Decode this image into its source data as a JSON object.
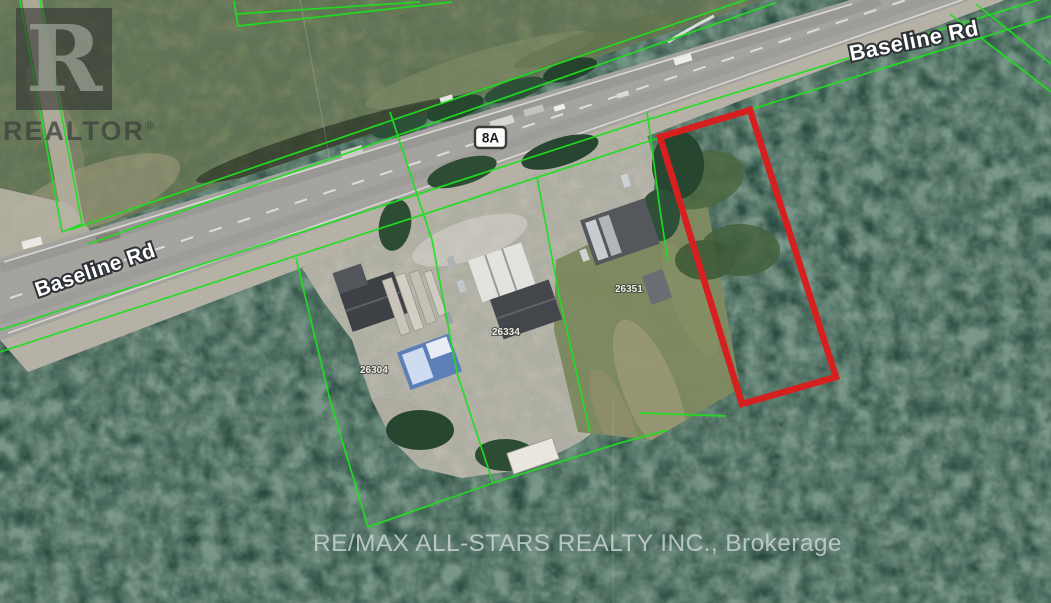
{
  "map": {
    "highway_shield_label": "8A",
    "road_label_west": "Baseline Rd",
    "road_label_northeast": "Baseline Rd",
    "address_labels": [
      "26304",
      "26334",
      "26351"
    ],
    "colors": {
      "parcel_boundary_green": "#1fdf1f",
      "subject_parcel_red": "#d62020"
    }
  },
  "watermarks": {
    "realtor_letter": "R",
    "realtor_name": "REALTOR",
    "registered_mark": "®",
    "brokerage": "RE/MAX ALL-STARS REALTY INC., Brokerage"
  }
}
